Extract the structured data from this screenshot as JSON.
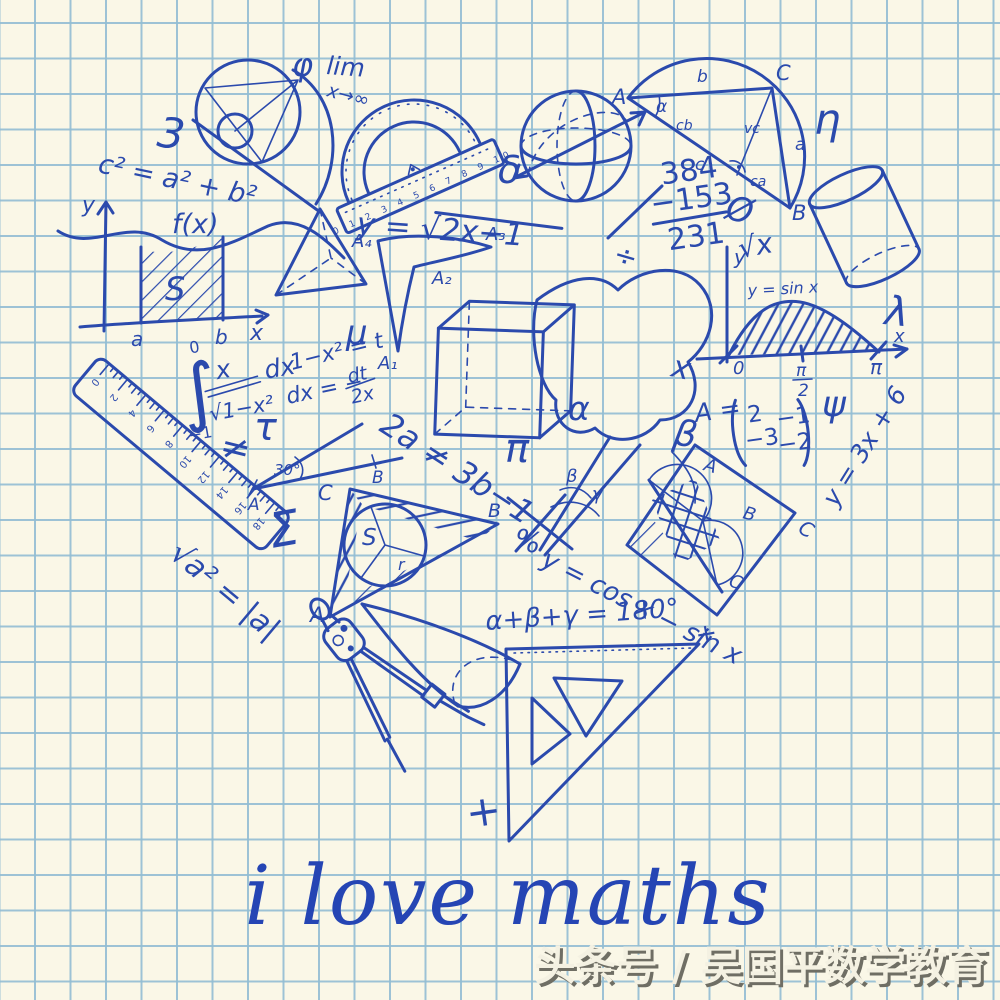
{
  "canvas": {
    "title_text": "i love maths",
    "watermark_text": "头条号 / 吴国平数学教育"
  },
  "colors": {
    "ink": "#2b4aad",
    "paper": "#faf7e7",
    "grid": "#92bdd3",
    "title": "#2545b4",
    "watermark_fill": "#f4f1e2",
    "watermark_shadow": "#6f6e64"
  },
  "labels": {
    "three": "3",
    "pythagoras": "c² = a² + b²",
    "phi": "φ",
    "lim": "lim",
    "lim_sub": "x→∞",
    "fx": "f(x)",
    "fx_y": "y",
    "fx_x": "x",
    "fx_a": "a",
    "fx_b": "b",
    "area_s": "S",
    "delta": "δ",
    "sqrt_eq": "y = √2x−1",
    "tri_circ_A": "A",
    "tri_circ_B": "B",
    "tri_circ_C": "C",
    "tri_circ_alpha": "α",
    "tri_circ_a": "a",
    "tri_circ_b": "b",
    "tri_circ_c": "c",
    "tri_circ_cb": "cb",
    "tri_circ_ca": "ca",
    "tri_circ_vc": "vc",
    "eta": "η",
    "sub_top": "384",
    "sub_mid": "−153",
    "sub_result": "231",
    "empty_set": "Ø",
    "sqrt_x": "√x",
    "sin_eq": "y = sin x",
    "sin_zero": "0",
    "sin_pi_num": "π",
    "sin_pi_den": "2",
    "sin_pi": "π",
    "sin_x": "x",
    "sin_y": "y",
    "lambda": "λ",
    "psi": "ψ",
    "matrix_name": "A =",
    "matrix_r1c1": "2",
    "matrix_r1c2": "−1",
    "matrix_r2c1": "−3",
    "matrix_r2c2": "−2",
    "line_eq": "y = 3x + 6",
    "mu": "μ",
    "integral_sign": "∫",
    "integral_upper": "0",
    "integral_lower": "−1",
    "integral_num": "x",
    "integral_den": "√1−x²",
    "integral_dx": "dx",
    "subst_1": "1−x² = t",
    "subst_2": "dx = −",
    "subst_2_num": "dt",
    "subst_2_den": "2x",
    "neq": "≠",
    "tau": "τ",
    "deg30": "30°",
    "deg30_A": "A",
    "deg30_B": "B",
    "sigma": "Σ",
    "sqrt_abs": "√a² = |a|",
    "inc_A": "A",
    "inc_B": "B",
    "inc_C": "C",
    "inc_S": "S",
    "inc_r": "r",
    "percent": "%",
    "obelus": "÷",
    "x_mark": "x",
    "alpha": "α",
    "pi": "π",
    "beta": "β",
    "ineq": "2a ≠ 3b−1",
    "ang_beta": "β",
    "ang_gamma": "γ",
    "cos_eq": "y = cos x − sin x",
    "sq_A": "A",
    "sq_B": "B",
    "sq_C": "C",
    "sq_corner": "C",
    "sum_eq": "α+β+γ = 180°",
    "plus": "+",
    "a1": "A₁",
    "a2": "A₂",
    "a3": "A₃",
    "a4": "A₄"
  },
  "ruler_numbers": [
    "0",
    "2",
    "4",
    "6",
    "8",
    "10",
    "12",
    "14",
    "16",
    "18"
  ],
  "protractor_numbers": "0 1 2 3 4 5 6 7 8 9 10"
}
